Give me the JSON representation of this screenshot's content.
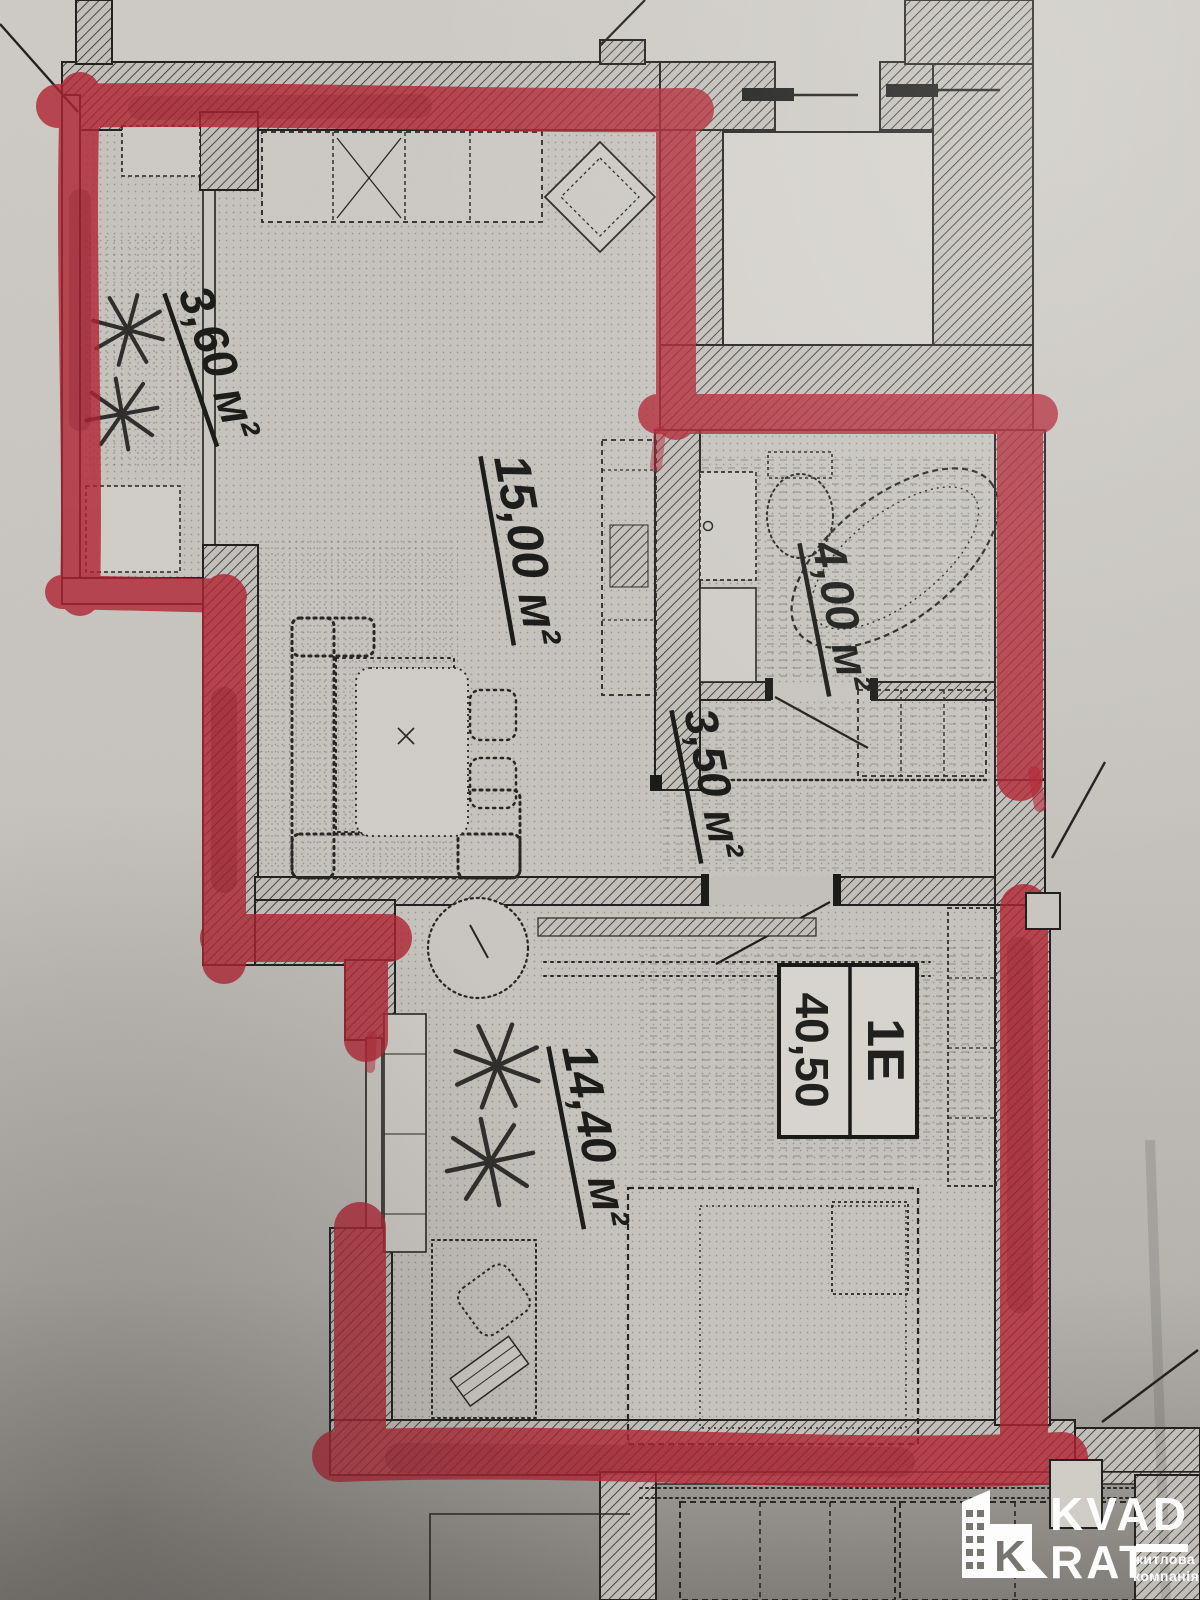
{
  "plan": {
    "rooms": [
      {
        "name": "balcony",
        "area_label": "3,60 м²"
      },
      {
        "name": "kitchen-living",
        "area_label": "15,00 м²"
      },
      {
        "name": "bathroom",
        "area_label": "4,00 м²"
      },
      {
        "name": "hallway",
        "area_label": "3,50 м²"
      },
      {
        "name": "bedroom",
        "area_label": "14,40 м²"
      }
    ],
    "unit_tag": {
      "type_code": "1Е",
      "total_area": "40,50"
    }
  },
  "logo": {
    "word_top": "KVAD",
    "word_bottom": "RAT",
    "tagline_line1": "житлова",
    "tagline_line2": "компанія",
    "monogram_letter": "K"
  },
  "colors": {
    "marker_red": "#b01f2e",
    "paper": "#c8c5bf",
    "ink": "#1f1f1f",
    "logo_white": "#ffffff"
  }
}
